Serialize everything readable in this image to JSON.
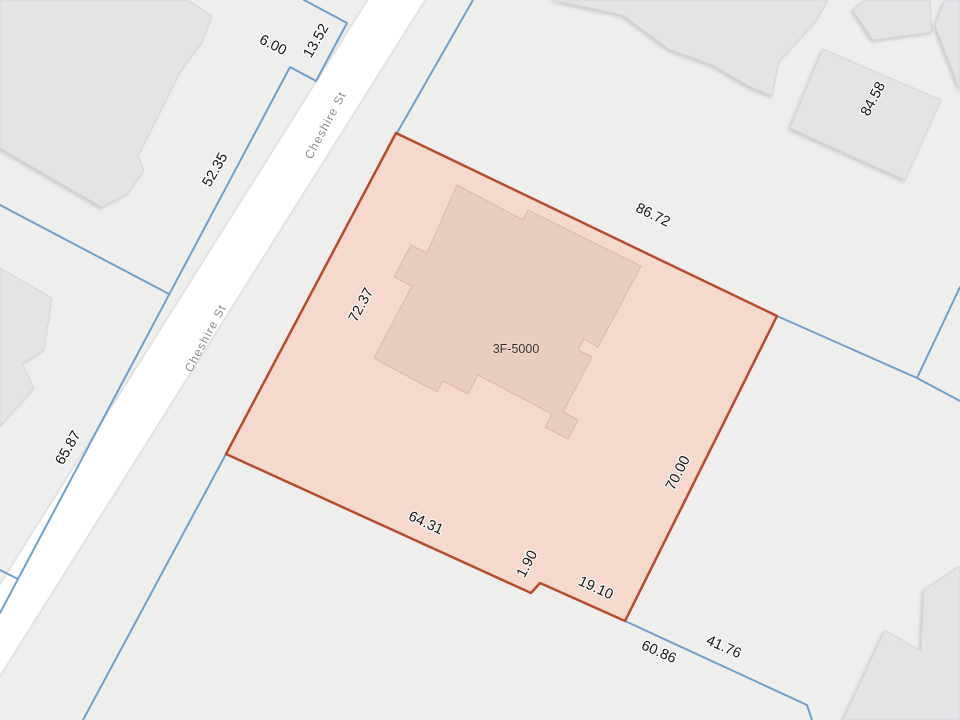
{
  "map": {
    "background_color": "#eeeeec",
    "colors": {
      "boundary_blue": "#6fa0cc",
      "parcel_stroke": "#b94b2d",
      "parcel_fill": "#f4d9cc",
      "parcel_building_fill": "#e9cdbf",
      "parcel_building_stroke": "#dcb9a7",
      "building_fill": "#e3e4e6",
      "building_stroke": "#d5d6d9",
      "street_fill": "#ffffff",
      "street_edge": "#e2e2e0",
      "dimension_text": "#161616",
      "street_text": "#8c8c8c",
      "building_text": "#333333"
    },
    "street": {
      "name": "Cheshire St",
      "polygon": "380,-20 438,-20 -37,735 -95,735"
    },
    "selected_parcel": {
      "id_label": "3F-5000",
      "polygon": "396,133 777,316 625,621 540,583 531,593 226,454",
      "building_polygon": "457,185 523,220 528,210 641,266 598,347 584,339 578,350 592,357 563,412 578,420 568,439 545,427 552,414 478,375 468,394 443,381 437,392 394,369 374,358 412,286 394,277 411,245 427,253"
    },
    "boundary_lines": [
      "473,0 397,133",
      "226,454 83,720",
      "777,316 917,378 960,401",
      "917,378 960,287",
      "625,621 807,705 812,720",
      "304,0 347,23 316,81 290,67 18,579 0,613",
      "169,294 0,205",
      "18,579 0,570"
    ],
    "buildings": [
      "0,0 188,0 212,16 202,42 181,70 138,156 144,170 128,193 102,207 0,148",
      "0,268 52,298 44,350 22,363 34,388 0,426",
      "552,0 828,0 815,22 804,34 779,61 772,96 747,85 713,65 669,49 623,15",
      "823,49 941,100 905,180 790,128",
      "853,10 865,0 930,0 932,32 873,40",
      "945,0 960,0 960,90 935,25",
      "843,720 885,630 921,651 924,590 960,566 960,720"
    ],
    "labels": [
      {
        "text": "6.00",
        "x": 271,
        "y": 49,
        "rot": 27,
        "kind": "dimension"
      },
      {
        "text": "13.52",
        "x": 320,
        "y": 43,
        "rot": -60,
        "kind": "dimension"
      },
      {
        "text": "52.35",
        "x": 219,
        "y": 172,
        "rot": -60,
        "kind": "dimension"
      },
      {
        "text": "65.87",
        "x": 72,
        "y": 450,
        "rot": -60,
        "kind": "dimension"
      },
      {
        "text": "84.58",
        "x": 877,
        "y": 101,
        "rot": -62,
        "kind": "dimension"
      },
      {
        "text": "86.72",
        "x": 651,
        "y": 219,
        "rot": 26,
        "kind": "dimension"
      },
      {
        "text": "72.37",
        "x": 365,
        "y": 307,
        "rot": -62,
        "kind": "dimension"
      },
      {
        "text": "70.00",
        "x": 682,
        "y": 475,
        "rot": -63,
        "kind": "dimension"
      },
      {
        "text": "64.31",
        "x": 424,
        "y": 527,
        "rot": 25,
        "kind": "dimension"
      },
      {
        "text": "1.90",
        "x": 531,
        "y": 566,
        "rot": -62,
        "kind": "dimension"
      },
      {
        "text": "19.10",
        "x": 594,
        "y": 592,
        "rot": 25,
        "kind": "dimension"
      },
      {
        "text": "60.86",
        "x": 657,
        "y": 656,
        "rot": 24,
        "kind": "dimension"
      },
      {
        "text": "41.76",
        "x": 722,
        "y": 651,
        "rot": 24,
        "kind": "dimension"
      },
      {
        "text": "Cheshire St",
        "x": 329,
        "y": 127,
        "rot": -62,
        "kind": "street"
      },
      {
        "text": "Cheshire St",
        "x": 209,
        "y": 340,
        "rot": -62,
        "kind": "street"
      },
      {
        "text": "3F-5000",
        "x": 516,
        "y": 353,
        "rot": 0,
        "kind": "building"
      }
    ]
  }
}
